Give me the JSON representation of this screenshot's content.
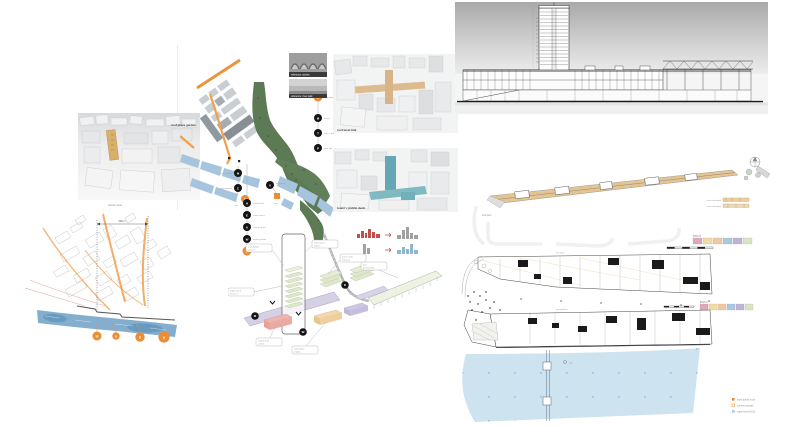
{
  "board": {
    "width": 800,
    "height": 427,
    "title": "waterfront masterplan presentation board"
  },
  "colors": {
    "accent_orange": "#ED8C33",
    "route_orange": "#F0A04E",
    "water_blue": "#A7C4DE",
    "park_green": "#5C7A54",
    "plan_water": "#CDE3F0",
    "highlight_tan": "#D8B06B",
    "highlight_teal": "#63A8B4",
    "sketch_water": "#6FA0C6",
    "key_strip": [
      "#E2A7B6",
      "#F0DDA2",
      "#EFC9A2",
      "#A9C8E2",
      "#BFB3D6",
      "#D9E4C2"
    ]
  },
  "massing_view_1": {
    "label": "roof plaza garden",
    "caption": "aerial view"
  },
  "massing_view_2": {
    "label": "roof level link"
  },
  "massing_view_3": {
    "label": "tower + public deck"
  },
  "photos": {
    "caption_1": "reference: arches",
    "caption_2": "reference: river park"
  },
  "site_plan": {
    "chainA": [
      {
        "glyph": "B",
        "label": "new bridge"
      },
      {
        "glyph": "M",
        "label": "metro"
      },
      {
        "glyph": "T",
        "label": "tram + bus"
      },
      {
        "glyph": "P",
        "label": "park link"
      }
    ],
    "chainB": [
      {
        "glyph": "M",
        "label": "metro station"
      },
      {
        "glyph": "C",
        "label": "city terminal"
      }
    ],
    "chainB_site": {
      "glyph": "S",
      "label": "site"
    },
    "chainC": [
      {
        "glyph": "H",
        "label": "market hall"
      },
      {
        "glyph": "E",
        "label": "event space"
      },
      {
        "glyph": "A",
        "label": "boat harbour"
      },
      {
        "glyph": "W",
        "label": "winter garden"
      }
    ],
    "chainC_parking": {
      "glyph": "P",
      "label": "parking"
    },
    "spot": {
      "glyph": "V",
      "label": "viewpoint"
    },
    "site_marker_label": "site"
  },
  "sketch": {
    "dim_label": "300 m",
    "markers": [
      {
        "glyph": "M"
      },
      {
        "glyph": "K"
      },
      {
        "glyph": "S"
      },
      {
        "glyph": "V"
      }
    ]
  },
  "axon": {
    "labels": {
      "roof_garden": {
        "t": "roof garden",
        "s": "terrace"
      },
      "tower": {
        "t": "hotel tower",
        "s": "offices"
      },
      "plates": {
        "t": "green roofs",
        "s": "terraces"
      },
      "deck": {
        "t": "public deck",
        "s": "level +4"
      },
      "market": {
        "t": "market hall",
        "s": "events"
      },
      "workshops": {
        "t": "workshops",
        "s": "studios"
      },
      "pier": {
        "t": "pier",
        "s": "promenade"
      },
      "road": "RUOHOLAHTI"
    }
  },
  "roof_plan": {
    "caption": "roof plan",
    "legend_a": "north elevation",
    "legend_b": "south elevation",
    "key_caption": "level +2"
  },
  "plans": {
    "plan_a_caption": "first floor",
    "plan_b_caption": "ground floor",
    "key_caption": "level +1",
    "pier_label": "pier",
    "legend": [
      {
        "label": "main public route"
      },
      {
        "label": "covered arcade"
      },
      {
        "label": "water level ±0.00"
      }
    ]
  }
}
